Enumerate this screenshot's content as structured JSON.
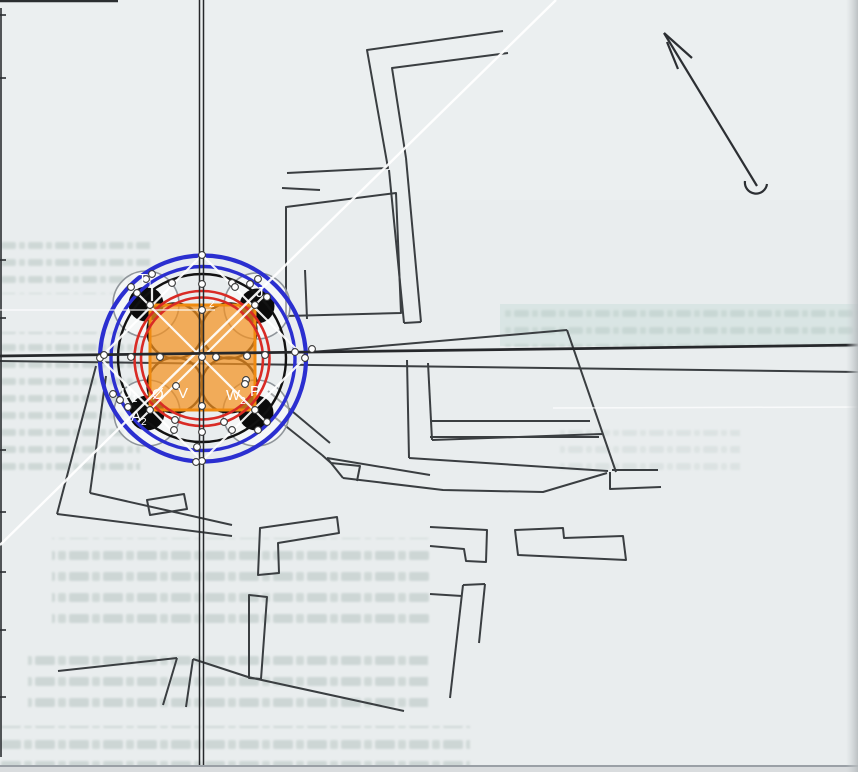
{
  "document": {
    "kind": "scanned site plan with geometric proportion overlay",
    "page_texture": "faint mirrored print bleed-through (illegible)"
  },
  "compass": {
    "icon": "north-arrow"
  },
  "overlay": {
    "center": {
      "x": 202,
      "y": 358
    },
    "colors": {
      "blue_circle": "#2b2fd0",
      "red_circle": "#d92b25",
      "orange_square_fill": "#f4921f",
      "orange_square_stroke": "#ef8a10",
      "black_geometry": "#121212",
      "gray_circle": "#8f959a",
      "construction_white": "#ffffff",
      "map_ink": "#3a3e41"
    },
    "circles": {
      "blue_outer_r": 103,
      "blue_inner_r": 92,
      "black_outer_r": 84,
      "red_outer_r": 67.5,
      "red_inner_r": 61,
      "petal_r": 27.5,
      "petal_offset": 27,
      "disk_r": 17.5,
      "gray_r": 33,
      "diagonal_offset": 78
    },
    "square": {
      "x": 150,
      "y": 305,
      "size": 105
    },
    "point_labels": [
      {
        "id": "T1",
        "main": "T",
        "sub": "1",
        "x": 138,
        "y": 284
      },
      {
        "id": "sub2",
        "main": "",
        "sub": "2",
        "x": 209,
        "y": 303
      },
      {
        "id": "J",
        "main": "J",
        "sub": "",
        "x": 256,
        "y": 297
      },
      {
        "id": "U1",
        "main": "U",
        "sub": "1",
        "x": 121,
        "y": 398
      },
      {
        "id": "O",
        "main": "Ø",
        "sub": "",
        "x": 152,
        "y": 399
      },
      {
        "id": "V",
        "main": "V",
        "sub": "",
        "x": 178,
        "y": 398
      },
      {
        "id": "W2",
        "main": "W",
        "sub": "2",
        "x": 226,
        "y": 400
      },
      {
        "id": "P",
        "main": "P",
        "sub": "",
        "x": 250,
        "y": 396
      },
      {
        "id": "A2",
        "main": "A",
        "sub": "2",
        "x": 131,
        "y": 421
      }
    ],
    "control_points": [
      [
        202,
        255
      ],
      [
        305,
        358
      ],
      [
        202,
        461
      ],
      [
        100,
        358
      ],
      [
        202,
        284
      ],
      [
        202,
        310
      ],
      [
        202,
        406
      ],
      [
        202,
        432
      ],
      [
        104,
        355
      ],
      [
        131,
        357
      ],
      [
        160,
        357
      ],
      [
        202,
        357
      ],
      [
        216,
        357
      ],
      [
        247,
        356
      ],
      [
        265,
        355
      ],
      [
        295,
        352
      ],
      [
        312,
        349
      ],
      [
        150,
        305
      ],
      [
        255,
        305
      ],
      [
        150,
        410
      ],
      [
        255,
        410
      ],
      [
        232,
        283
      ],
      [
        172,
        283
      ],
      [
        232,
        430
      ],
      [
        174,
        430
      ],
      [
        131,
        287
      ],
      [
        137,
        293
      ],
      [
        146,
        279
      ],
      [
        152,
        274
      ],
      [
        235,
        287
      ],
      [
        250,
        284
      ],
      [
        258,
        279
      ],
      [
        267,
        297
      ],
      [
        113,
        394
      ],
      [
        120,
        400
      ],
      [
        128,
        407
      ],
      [
        246,
        380
      ],
      [
        267,
        422
      ],
      [
        258,
        430
      ],
      [
        176,
        386
      ],
      [
        245,
        384
      ],
      [
        175,
        420
      ],
      [
        224,
        422
      ],
      [
        197,
        447
      ],
      [
        196,
        462
      ]
    ]
  }
}
